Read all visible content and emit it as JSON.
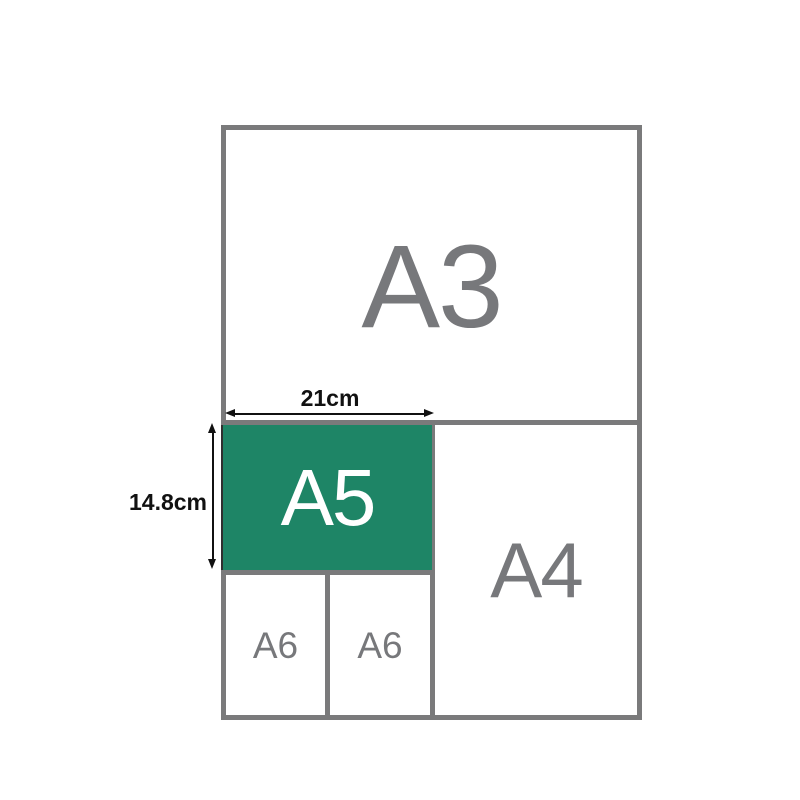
{
  "colors": {
    "highlight_green": "#1E8566",
    "frame_gray": "#7A7A7B",
    "label_gray": "#77787B",
    "dimension_black": "#111111",
    "a5_text_white": "#FFFFFF",
    "background_white": "#FFFFFF"
  },
  "sheets": {
    "a3": {
      "label": "A3"
    },
    "a4": {
      "label": "A4"
    },
    "a5": {
      "label": "A5",
      "width_cm": 21,
      "height_cm": 14.8
    },
    "a6_left": {
      "label": "A6"
    },
    "a6_right": {
      "label": "A6"
    }
  },
  "dimensions": {
    "width_label": "21cm",
    "height_label": "14.8cm"
  }
}
